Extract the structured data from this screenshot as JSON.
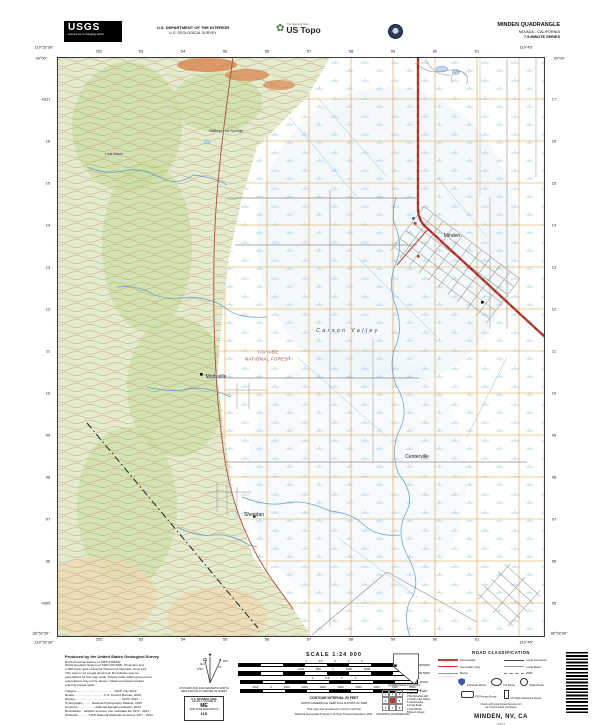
{
  "header": {
    "usgs_word": "USGS",
    "usgs_tagline": "science for a changing world",
    "dept_line1": "U.S. DEPARTMENT OF THE INTERIOR",
    "dept_line2": "U.S. GEOLOGICAL SURVEY",
    "ustopo_icon": "✿",
    "ustopo_tagline": "The National Map",
    "ustopo_word": "US Topo",
    "quad_title": "MINDEN QUADRANGLE",
    "quad_state": "NEVADA - CALIFORNIA",
    "quad_series": "7.5-MINUTE SERIES"
  },
  "map": {
    "labels": [
      {
        "t": "119°52'30\"",
        "x": 44,
        "y": 47,
        "c": "corner"
      },
      {
        "t": "39°00'",
        "x": 41,
        "y": 58,
        "c": "corner"
      },
      {
        "t": "119°45'",
        "x": 526,
        "y": 47,
        "c": "corner"
      },
      {
        "t": "39°00'",
        "x": 559,
        "y": 58,
        "c": "corner"
      },
      {
        "t": "38°52'30\"",
        "x": 41,
        "y": 633,
        "c": "corner"
      },
      {
        "t": "119°52'30\"",
        "x": 44,
        "y": 642,
        "c": "corner"
      },
      {
        "t": "119°45'",
        "x": 526,
        "y": 642,
        "c": "corner"
      },
      {
        "t": "38°52'30\"",
        "x": 559,
        "y": 633,
        "c": "corner"
      },
      {
        "t": "252",
        "x": 99,
        "y": 51,
        "c": "grid"
      },
      {
        "t": "53",
        "x": 141,
        "y": 51,
        "c": "grid"
      },
      {
        "t": "54",
        "x": 183,
        "y": 51,
        "c": "grid"
      },
      {
        "t": "55",
        "x": 225,
        "y": 51,
        "c": "grid"
      },
      {
        "t": "56",
        "x": 267,
        "y": 51,
        "c": "grid"
      },
      {
        "t": "57",
        "x": 309,
        "y": 51,
        "c": "grid"
      },
      {
        "t": "58",
        "x": 351,
        "y": 51,
        "c": "grid"
      },
      {
        "t": "59",
        "x": 393,
        "y": 51,
        "c": "grid"
      },
      {
        "t": "60",
        "x": 435,
        "y": 51,
        "c": "grid"
      },
      {
        "t": "61",
        "x": 477,
        "y": 51,
        "c": "grid"
      },
      {
        "t": "252",
        "x": 99,
        "y": 639,
        "c": "grid"
      },
      {
        "t": "53",
        "x": 141,
        "y": 639,
        "c": "grid"
      },
      {
        "t": "54",
        "x": 183,
        "y": 639,
        "c": "grid"
      },
      {
        "t": "55",
        "x": 225,
        "y": 639,
        "c": "grid"
      },
      {
        "t": "56",
        "x": 267,
        "y": 639,
        "c": "grid"
      },
      {
        "t": "57",
        "x": 309,
        "y": 639,
        "c": "grid"
      },
      {
        "t": "58",
        "x": 351,
        "y": 639,
        "c": "grid"
      },
      {
        "t": "59",
        "x": 393,
        "y": 639,
        "c": "grid"
      },
      {
        "t": "60",
        "x": 435,
        "y": 639,
        "c": "grid"
      },
      {
        "t": "61",
        "x": 477,
        "y": 639,
        "c": "grid"
      },
      {
        "t": "4317",
        "x": 46,
        "y": 99,
        "c": "grid"
      },
      {
        "t": "16",
        "x": 48,
        "y": 141,
        "c": "grid"
      },
      {
        "t": "15",
        "x": 48,
        "y": 183,
        "c": "grid"
      },
      {
        "t": "14",
        "x": 48,
        "y": 225,
        "c": "grid"
      },
      {
        "t": "13",
        "x": 48,
        "y": 267,
        "c": "grid"
      },
      {
        "t": "12",
        "x": 48,
        "y": 309,
        "c": "grid"
      },
      {
        "t": "11",
        "x": 48,
        "y": 351,
        "c": "grid"
      },
      {
        "t": "10",
        "x": 48,
        "y": 393,
        "c": "grid"
      },
      {
        "t": "09",
        "x": 48,
        "y": 435,
        "c": "grid"
      },
      {
        "t": "08",
        "x": 48,
        "y": 477,
        "c": "grid"
      },
      {
        "t": "07",
        "x": 48,
        "y": 519,
        "c": "grid"
      },
      {
        "t": "06",
        "x": 48,
        "y": 561,
        "c": "grid"
      },
      {
        "t": "4305",
        "x": 46,
        "y": 603,
        "c": "grid"
      },
      {
        "t": "17",
        "x": 554,
        "y": 99,
        "c": "grid"
      },
      {
        "t": "16",
        "x": 554,
        "y": 141,
        "c": "grid"
      },
      {
        "t": "15",
        "x": 554,
        "y": 183,
        "c": "grid"
      },
      {
        "t": "14",
        "x": 554,
        "y": 225,
        "c": "grid"
      },
      {
        "t": "13",
        "x": 554,
        "y": 267,
        "c": "grid"
      },
      {
        "t": "12",
        "x": 554,
        "y": 309,
        "c": "grid"
      },
      {
        "t": "11",
        "x": 554,
        "y": 351,
        "c": "grid"
      },
      {
        "t": "10",
        "x": 554,
        "y": 393,
        "c": "grid"
      },
      {
        "t": "09",
        "x": 554,
        "y": 435,
        "c": "grid"
      },
      {
        "t": "08",
        "x": 554,
        "y": 477,
        "c": "grid"
      },
      {
        "t": "07",
        "x": 554,
        "y": 519,
        "c": "grid"
      },
      {
        "t": "06",
        "x": 554,
        "y": 561,
        "c": "grid"
      },
      {
        "t": "05",
        "x": 554,
        "y": 603,
        "c": "grid"
      },
      {
        "t": "Walleys Hot Springs",
        "x": 226,
        "y": 131,
        "c": "small"
      },
      {
        "t": "Lost Basin",
        "x": 114,
        "y": 154,
        "c": "small"
      },
      {
        "t": "Minden",
        "x": 452,
        "y": 236,
        "c": "place"
      },
      {
        "t": "Mottsville",
        "x": 216,
        "y": 377,
        "c": "place"
      },
      {
        "t": "Sheridan",
        "x": 254,
        "y": 515,
        "c": "place"
      },
      {
        "t": "Centerville",
        "x": 417,
        "y": 457,
        "c": "place"
      },
      {
        "t": "TOIYABE",
        "x": 268,
        "y": 352,
        "c": "forest"
      },
      {
        "t": "NATIONAL FOREST",
        "x": 268,
        "y": 359,
        "c": "forest"
      },
      {
        "t": "Carson Valley",
        "x": 348,
        "y": 331,
        "c": "valley"
      }
    ]
  },
  "footer": {
    "produced": "Produced by the United States Geological Survey",
    "credit_lines": [
      "North American Datum of 1983 (NAD83)",
      "World Geodetic System of 1984 (WGS84). Projection and",
      "1 000-meter grid: Universal Transverse Mercator, Zone 11S",
      "This map is not a legal document. Boundaries may be",
      "generalized for this map scale. Private lands within government",
      "reservations may not be shown. Obtain permission before",
      "entering private lands."
    ],
    "source_lines": [
      "Imagery.............................................NAIP, July 2019",
      "Roads...................................U.S. Census Bureau, 2020",
      "Names.......................................................GNIS, 2021",
      "Hydrography...........National Hydrography Dataset, 2015",
      "Contours.....................National Elevation Dataset, 2013",
      "Boundaries....Multiple sources; see metadata file 1972 - 2021",
      "Wetlands.............FWS National Wetlands Inventory 1977 - 2014"
    ],
    "declination": {
      "star": "★",
      "gn": "GN",
      "gn_val": "0°52'",
      "mn": "MN",
      "mn_val": "13°",
      "cap1": "UTM GRID AND 2021 MAGNETIC NORTH",
      "cap2": "DECLINATION AT CENTER OF SHEET"
    },
    "usng": {
      "title": "U.S. NATIONAL GRID",
      "sub1": "100,000-m SQUARE ID",
      "square_id": "ME",
      "sub2": "GRID ZONE DESIGNATION",
      "zone": "11S"
    },
    "scale": {
      "title": "SCALE 1:24 000",
      "bars": [
        {
          "labels": "1 0.5 0 1 2",
          "unit": "KILOMETERS"
        },
        {
          "labels": "1000 500 0 1000 2000",
          "unit": "METERS"
        },
        {
          "labels": "1 0.5 0 1",
          "unit": "MILES"
        },
        {
          "labels": "1000 0 1000 2000 3000 4000 5000 6000 7000 8000",
          "unit": "FEET",
          "c": "dense"
        }
      ],
      "contour1": "CONTOUR INTERVAL 20 FEET",
      "contour2": "NORTH AMERICAN VERTICAL DATUM OF 1988",
      "note1": "This map was produced to conform with the",
      "note2": "National Geospatial Program US Topo Product Standard, 2011."
    },
    "location_caption": "QUADRANGLE LOCATION",
    "adjoining": {
      "caption": "ADJOINING QUADRANGLES",
      "cells": [
        {
          "t": "1"
        },
        {
          "t": "2"
        },
        {
          "t": "3"
        },
        {
          "t": "4"
        },
        {
          "t": "",
          "c": "sel"
        },
        {
          "t": "5"
        },
        {
          "t": "6"
        },
        {
          "t": "7"
        },
        {
          "t": "8"
        }
      ],
      "names": [
        "1 Glenbrook",
        "2 Genoa",
        "3 McTarnahan Hill",
        "4 South Lake Tahoe",
        "5 Gardnerville",
        "6 Freel Peak",
        "7 Woodfords",
        "8 Mount Siegel"
      ]
    },
    "road_class": {
      "title": "ROAD CLASSIFICATION",
      "expressway": "Expressway",
      "secondary": "Secondary Hwy",
      "ramp": "Ramp",
      "local_connector": "Local Connector",
      "local_road": "Local Road",
      "fourwd": "4WD",
      "interstate": "Interstate Route",
      "us_route": "US Route",
      "state_route": "State Route",
      "fs_primary": "FS Primary Route",
      "fs_high": "FS High Clearance Route",
      "note1": "Check with local Forest Service unit",
      "note2": "for current travel conditions"
    },
    "title_block": {
      "name": "MINDEN, NV, CA",
      "year": "2021"
    }
  }
}
